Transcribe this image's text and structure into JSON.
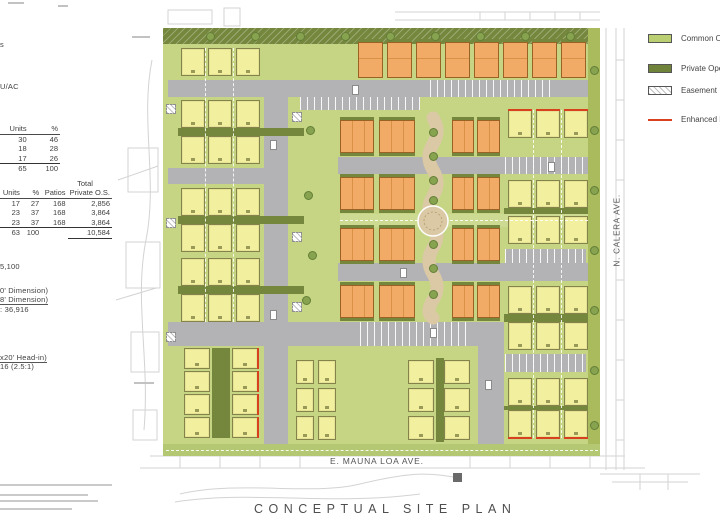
{
  "page_title": "CONCEPTUAL SITE PLAN",
  "left_panel": {
    "fragments": [
      {
        "id": "f1",
        "text": "s"
      },
      {
        "id": "f2",
        "text": "U/AC"
      },
      {
        "id": "f3",
        "text": "5,100"
      },
      {
        "id": "f4",
        "text": "0' Dimension)"
      },
      {
        "id": "f5",
        "text": "8' Dimension)"
      },
      {
        "id": "f6",
        "text": ": 36,916"
      },
      {
        "id": "f7",
        "text": "x20' Head-in)"
      },
      {
        "id": "f8",
        "text": "16 (2.5:1)"
      }
    ],
    "unit_mix_table": {
      "headers": [
        "Units",
        "%"
      ],
      "rows": [
        [
          "30",
          "46"
        ],
        [
          "18",
          "28"
        ],
        [
          "17",
          "26"
        ]
      ],
      "total": [
        "65",
        "100"
      ]
    },
    "open_space_table": {
      "super_header": "Total",
      "headers": [
        "Units",
        "%",
        "Patios",
        "Private O.S."
      ],
      "rows": [
        [
          "17",
          "27",
          "168",
          "2,856"
        ],
        [
          "23",
          "37",
          "168",
          "3,864"
        ],
        [
          "23",
          "37",
          "168",
          "3,864"
        ]
      ],
      "total": [
        "63",
        "100",
        "",
        "10,584"
      ]
    }
  },
  "site_plan": {
    "street_bottom": "E. MAUNA LOA AVE.",
    "street_right": "N. CALERA AVE."
  },
  "legend": {
    "items": [
      {
        "name": "common-open-space",
        "label": "Common Open Space",
        "swatch": "common"
      },
      {
        "name": "private-open-space",
        "label": "Private Open Space",
        "swatch": "private"
      },
      {
        "name": "easement",
        "label": "Easement",
        "swatch": "easement"
      },
      {
        "name": "enhanced-elevations",
        "label": "Enhanced Elevations",
        "swatch": "redline"
      }
    ]
  },
  "colors": {
    "common_open": "#b9cf72",
    "private_open": "#6f833b",
    "road": "#b3b3b5",
    "yellow_unit": "#f2ef9e",
    "orange_unit": "#f0a865",
    "enhanced": "#d9411e",
    "paseo": "#dbc9a5"
  }
}
